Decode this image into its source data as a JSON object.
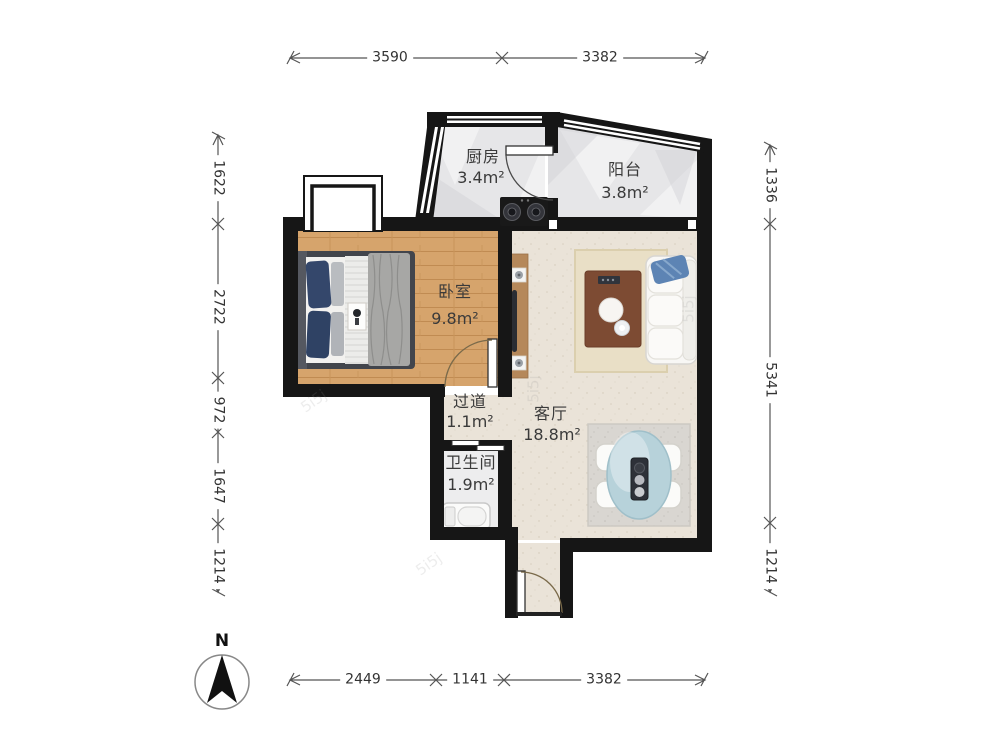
{
  "rooms": {
    "kitchen": {
      "name": "厨房",
      "area": "3.4m²"
    },
    "balcony": {
      "name": "阳台",
      "area": "3.8m²"
    },
    "bedroom": {
      "name": "卧室",
      "area": "9.8m²"
    },
    "hallway": {
      "name": "过道",
      "area": "1.1m²"
    },
    "living": {
      "name": "客厅",
      "area": "18.8m²"
    },
    "bathroom": {
      "name": "卫生间",
      "area": "1.9m²"
    }
  },
  "dimensions": {
    "top": [
      "3590",
      "3382"
    ],
    "bottom": [
      "2449",
      "1141",
      "3382"
    ],
    "left": [
      "1622",
      "2722",
      "972",
      "1647",
      "1214"
    ],
    "right": [
      "1336",
      "5341",
      "1214"
    ]
  },
  "compass": {
    "label": "N"
  },
  "watermark": {
    "text": "5i5j"
  },
  "colors": {
    "wall": "#161616",
    "wood_floor": "#d6a46c",
    "living_floor": "#eae3d8",
    "gray_floor": "#e6e6e8",
    "dining_table": "#b7d2da",
    "coffee_table": "#7d4b33",
    "pillow_blue": "#5d84b4"
  }
}
